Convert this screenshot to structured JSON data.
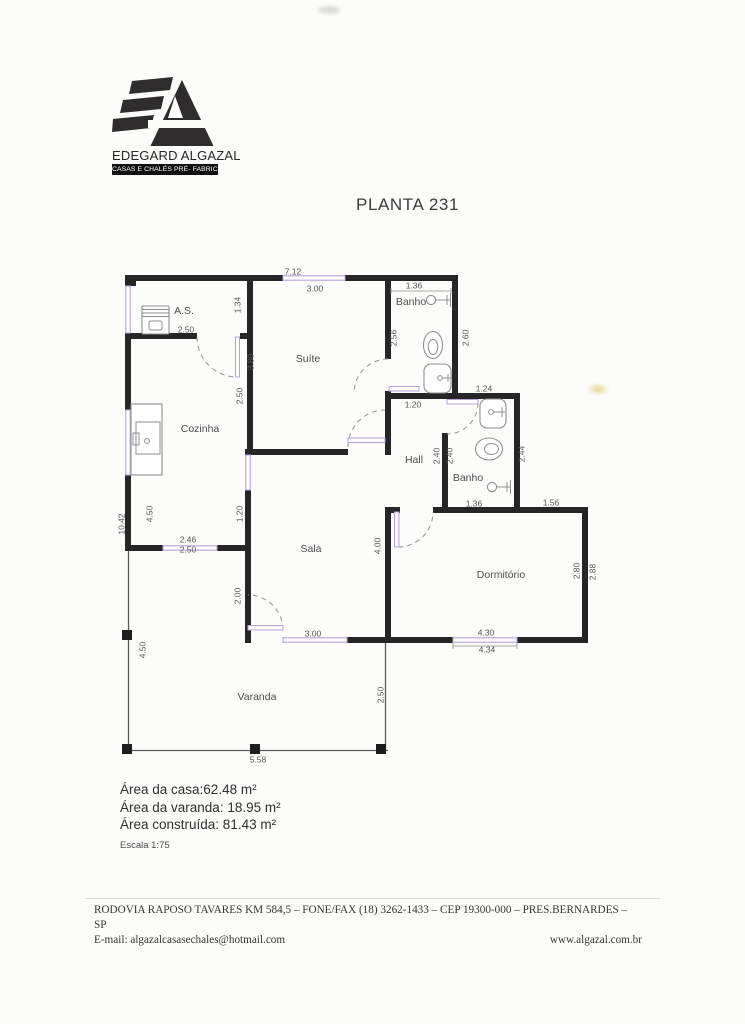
{
  "logo": {
    "name": "EDEGARD ALGAZAL",
    "tagline": "CASAS E CHALÉS PRÉ- FABRICADOS"
  },
  "title": "PLANTA 231",
  "plan": {
    "rooms": [
      {
        "label": "A.S.",
        "x": 184,
        "y": 311
      },
      {
        "label": "Suíte",
        "x": 308,
        "y": 359
      },
      {
        "label": "Banho",
        "x": 411,
        "y": 302
      },
      {
        "label": "Cozinha",
        "x": 200,
        "y": 429
      },
      {
        "label": "Hall",
        "x": 414,
        "y": 460
      },
      {
        "label": "Banho",
        "x": 468,
        "y": 478
      },
      {
        "label": "Sala",
        "x": 311,
        "y": 549
      },
      {
        "label": "Dormitório",
        "x": 501,
        "y": 575
      },
      {
        "label": "Varanda",
        "x": 257,
        "y": 697
      }
    ],
    "dimensions": [
      {
        "value": "7.12",
        "x": 293,
        "y": 272
      },
      {
        "value": "3.00",
        "x": 315,
        "y": 289
      },
      {
        "value": "1.36",
        "x": 414,
        "y": 286
      },
      {
        "value": "1.34",
        "x": 238,
        "y": 305,
        "rotated": true
      },
      {
        "value": "2.50",
        "x": 186,
        "y": 330
      },
      {
        "value": "2.56",
        "x": 394,
        "y": 338,
        "rotated": true
      },
      {
        "value": "2.60",
        "x": 466,
        "y": 338,
        "rotated": true
      },
      {
        "value": "3.80",
        "x": 251,
        "y": 362,
        "rotated": true
      },
      {
        "value": "2.50",
        "x": 240,
        "y": 396,
        "rotated": true
      },
      {
        "value": "1.24",
        "x": 484,
        "y": 389
      },
      {
        "value": "1.20",
        "x": 413,
        "y": 405
      },
      {
        "value": "2.40",
        "x": 437,
        "y": 456,
        "rotated": true
      },
      {
        "value": "2.40",
        "x": 450,
        "y": 456,
        "rotated": true
      },
      {
        "value": "2.44",
        "x": 522,
        "y": 454,
        "rotated": true
      },
      {
        "value": "1.36",
        "x": 474,
        "y": 504
      },
      {
        "value": "1.56",
        "x": 551,
        "y": 503
      },
      {
        "value": "4.50",
        "x": 150,
        "y": 514,
        "rotated": true
      },
      {
        "value": "10.42",
        "x": 122,
        "y": 524,
        "rotated": true
      },
      {
        "value": "1.20",
        "x": 240,
        "y": 514,
        "rotated": true
      },
      {
        "value": "4.00",
        "x": 378,
        "y": 546,
        "rotated": true
      },
      {
        "value": "2.46",
        "x": 188,
        "y": 540
      },
      {
        "value": "2.50",
        "x": 188,
        "y": 550
      },
      {
        "value": "2.00",
        "x": 238,
        "y": 596,
        "rotated": true
      },
      {
        "value": "2.80",
        "x": 577,
        "y": 571,
        "rotated": true
      },
      {
        "value": "2.88",
        "x": 593,
        "y": 572,
        "rotated": true
      },
      {
        "value": "3.00",
        "x": 313,
        "y": 634
      },
      {
        "value": "4.30",
        "x": 486,
        "y": 633
      },
      {
        "value": "4.34",
        "x": 487,
        "y": 650
      },
      {
        "value": "4.50",
        "x": 143,
        "y": 650,
        "rotated": true
      },
      {
        "value": "2.50",
        "x": 381,
        "y": 695,
        "rotated": true
      },
      {
        "value": "5.58",
        "x": 258,
        "y": 760
      }
    ]
  },
  "areas": {
    "house": "Área da casa:62.48 m²",
    "porch": "Área da varanda: 18.95 m²",
    "built": "Área construída: 81.43 m²",
    "scale": "Escala 1:75"
  },
  "footer": {
    "address": "RODOVIA RAPOSO TAVARES KM 584,5 – FONE/FAX (18) 3262-1433 – CEP 19300-000 – PRES.BERNARDES – SP",
    "email": "E-mail: algazalcasasechales@hotmail.com",
    "website": "www.algazal.com.br"
  },
  "colors": {
    "wall": "#262626",
    "window": "#b7a2d8",
    "label": "#4c4c4c",
    "smudge": "#d4b43c"
  }
}
